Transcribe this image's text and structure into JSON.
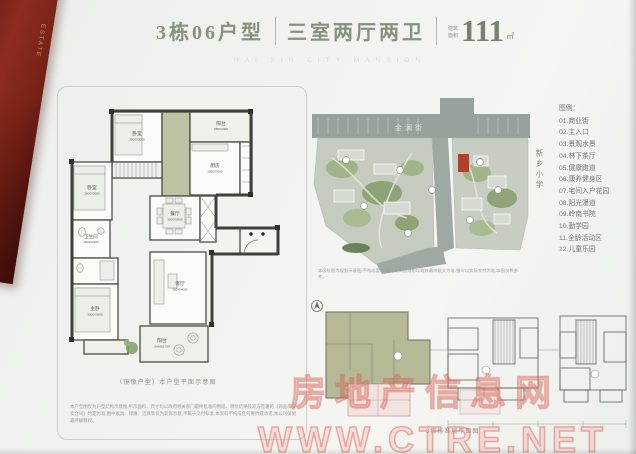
{
  "header": {
    "unit_title": "3栋06户型",
    "layout_title": "三室两厅两卫",
    "area_label": "建筑面积",
    "area_value": "111",
    "area_unit": "㎡",
    "brand_watermark": "HAI XIN CITY MANSION"
  },
  "spine": {
    "title": "地产",
    "subtitle": "ESTATE"
  },
  "floorplan": {
    "caption": "（镜像户型）本户型平面示意图",
    "disclaimer": "本户型图仅为户型结构示意图,所示面积、尺寸均以政府相关部门最终批准的图纸、测绘结果及双方签署的《商品房买卖合同》约定为准;图中家具、绿植、洁具等仅为装饰示意,不属于交付标准,本资料不构成任何要约或承诺,本公司保留最终解释权。",
    "rooms": {
      "bed2": {
        "label": "卧室",
        "dims": "2800X3050"
      },
      "balcony_service": {
        "label": "阳台",
        "dims": "850X2400"
      },
      "kitchen": {
        "label": "厨房",
        "dims": "1950X3600"
      },
      "bed3": {
        "label": "卧室",
        "dims": "2600X3000"
      },
      "bath": {
        "label": "卫生间",
        "dims": "1500X2300"
      },
      "dining": {
        "label": "餐厅",
        "dims": "3000X3900"
      },
      "living": {
        "label": "客厅",
        "dims": "3900X4050"
      },
      "master": {
        "label": "主卧",
        "dims": "3300X3600"
      },
      "balcony_main": {
        "label": "阳台",
        "dims": "6640X1700"
      }
    }
  },
  "siteplan": {
    "road_label": "金澜街",
    "school_label": "新乡小学",
    "note": "本区位图为规划示意图,不构成要约,项目及周边规划以政府最终批文为准,细节以实际交付为准,本图仅供参考。",
    "legend_title": "图例：",
    "legend_items": [
      "01.商业街",
      "02.主入口",
      "03.景观水景",
      "04.林下茶厅",
      "05.健康跑道",
      "06.康养健身区",
      "07.宅间入户花园",
      "08.阳光漫道",
      "09.岭南书院",
      "10.勤学园",
      "11.全龄活动区",
      "12.儿童乐园"
    ]
  },
  "floorplate": {
    "caption": "3栋标准层平面图"
  },
  "watermarks": {
    "site_name": "房地产信息网",
    "site_url": "WWW.CTRE.NET"
  },
  "colors": {
    "spine_red": "#7b2217",
    "spine_gold": "#c79d62",
    "title_green": "#87927e",
    "olive_fill": "#bcc2a2",
    "site_red_building": "#b2402b",
    "watermark_pink": "#e87a6e"
  }
}
